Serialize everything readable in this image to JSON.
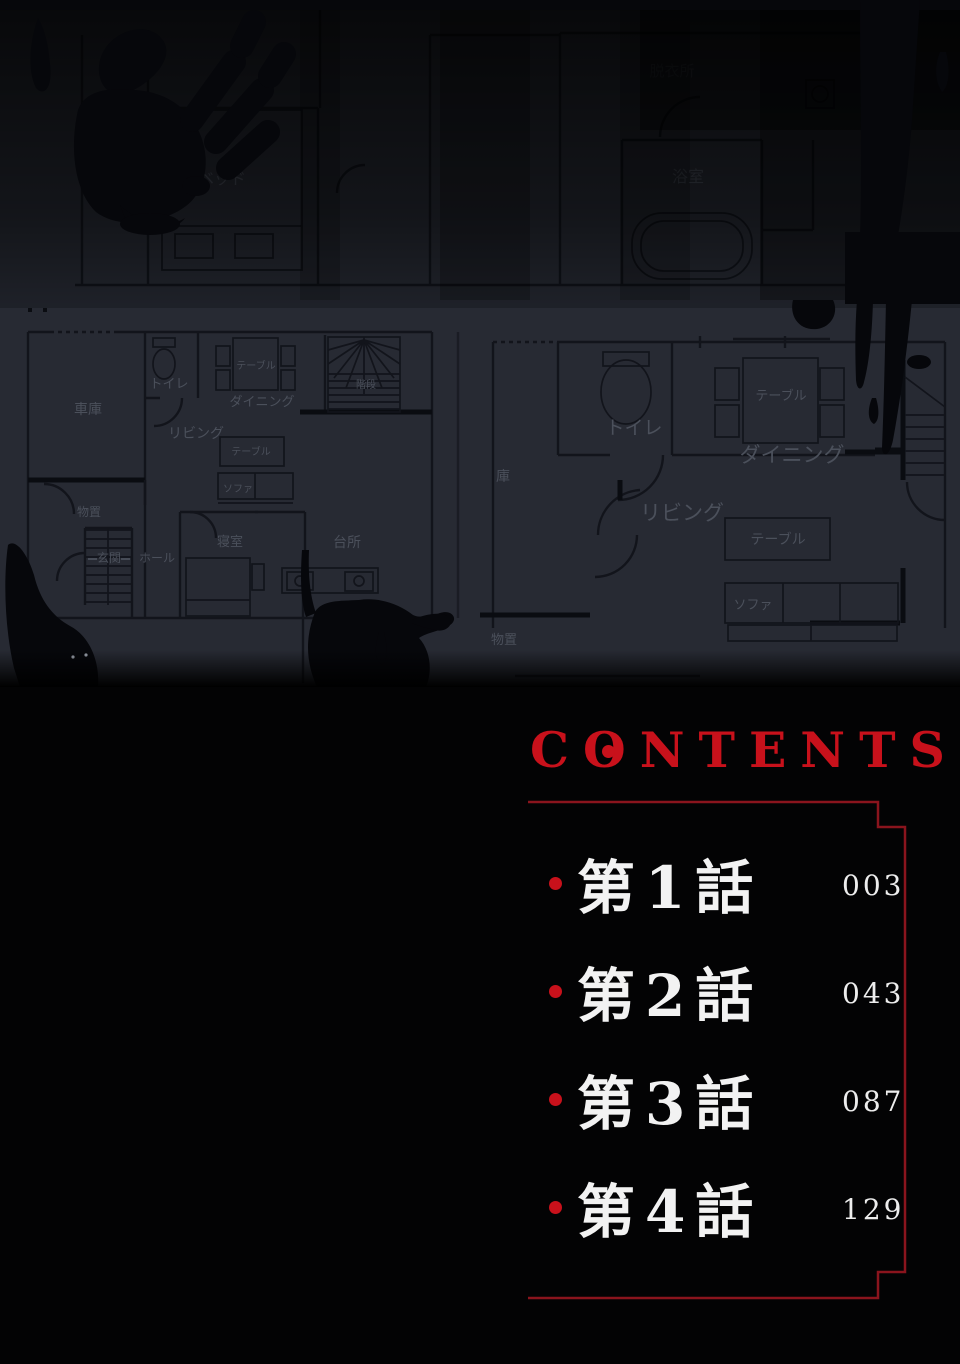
{
  "colors": {
    "accent_red": "#c8111b",
    "border_red": "#8a141d",
    "page_black": "#030304",
    "plan_background": "#272a33",
    "plan_wall": "#10121a",
    "plan_label": "#4b505b",
    "plan_label_dim": "#3a3e48",
    "blood_black": "#06070b",
    "chapter_text": "#f2f2f2"
  },
  "contents": {
    "title_parts": [
      "C",
      "O",
      "NTENTS"
    ],
    "items": [
      {
        "label": "第1話",
        "page": "003"
      },
      {
        "label": "第2話",
        "page": "043"
      },
      {
        "label": "第3話",
        "page": "087"
      },
      {
        "label": "第4話",
        "page": "129"
      }
    ]
  },
  "floorplan": {
    "labels": [
      {
        "t": "バルコ",
        "x": 100,
        "y": 120,
        "s": 13,
        "l": "upper"
      },
      {
        "t": "ベッド",
        "x": 222,
        "y": 184,
        "s": 16,
        "l": "upper"
      },
      {
        "t": "脱衣所",
        "x": 672,
        "y": 76,
        "s": 15,
        "l": "upper"
      },
      {
        "t": "浴室",
        "x": 688,
        "y": 182,
        "s": 16,
        "l": "upper"
      },
      {
        "t": "車庫",
        "x": 88,
        "y": 414,
        "s": 14,
        "l": "lower"
      },
      {
        "t": "トイレ",
        "x": 169,
        "y": 388,
        "s": 13,
        "l": "lower"
      },
      {
        "t": "テーブル",
        "x": 256,
        "y": 369,
        "s": 10,
        "l": "lower"
      },
      {
        "t": "ダイニング",
        "x": 262,
        "y": 406,
        "s": 13,
        "l": "lower"
      },
      {
        "t": "リビング",
        "x": 196,
        "y": 438,
        "s": 14,
        "l": "lower"
      },
      {
        "t": "テーブル",
        "x": 251,
        "y": 455,
        "s": 10,
        "l": "lower"
      },
      {
        "t": "ソファ",
        "x": 238,
        "y": 492,
        "s": 10,
        "l": "lower"
      },
      {
        "t": "階段",
        "x": 366,
        "y": 388,
        "s": 10,
        "l": "lower"
      },
      {
        "t": "物置",
        "x": 89,
        "y": 516,
        "s": 12,
        "l": "lower"
      },
      {
        "t": "玄関",
        "x": 109,
        "y": 562,
        "s": 12,
        "l": "lower"
      },
      {
        "t": "ホール",
        "x": 157,
        "y": 562,
        "s": 12,
        "l": "lower"
      },
      {
        "t": "寝室",
        "x": 230,
        "y": 546,
        "s": 13,
        "l": "lower"
      },
      {
        "t": "台所",
        "x": 347,
        "y": 547,
        "s": 14,
        "l": "lower"
      },
      {
        "t": "庫",
        "x": 503,
        "y": 481,
        "s": 14,
        "l": "lower"
      },
      {
        "t": "トイレ",
        "x": 634,
        "y": 434,
        "s": 19,
        "l": "lower"
      },
      {
        "t": "テーブル",
        "x": 781,
        "y": 400,
        "s": 13,
        "l": "lower"
      },
      {
        "t": "ダイニング",
        "x": 792,
        "y": 462,
        "s": 21,
        "l": "lower"
      },
      {
        "t": "リビング",
        "x": 682,
        "y": 520,
        "s": 21,
        "l": "lower"
      },
      {
        "t": "テーブル",
        "x": 778,
        "y": 544,
        "s": 14,
        "l": "lower"
      },
      {
        "t": "ソファ",
        "x": 753,
        "y": 609,
        "s": 13,
        "l": "lower"
      },
      {
        "t": "物置",
        "x": 504,
        "y": 644,
        "s": 13,
        "l": "lower"
      }
    ]
  }
}
